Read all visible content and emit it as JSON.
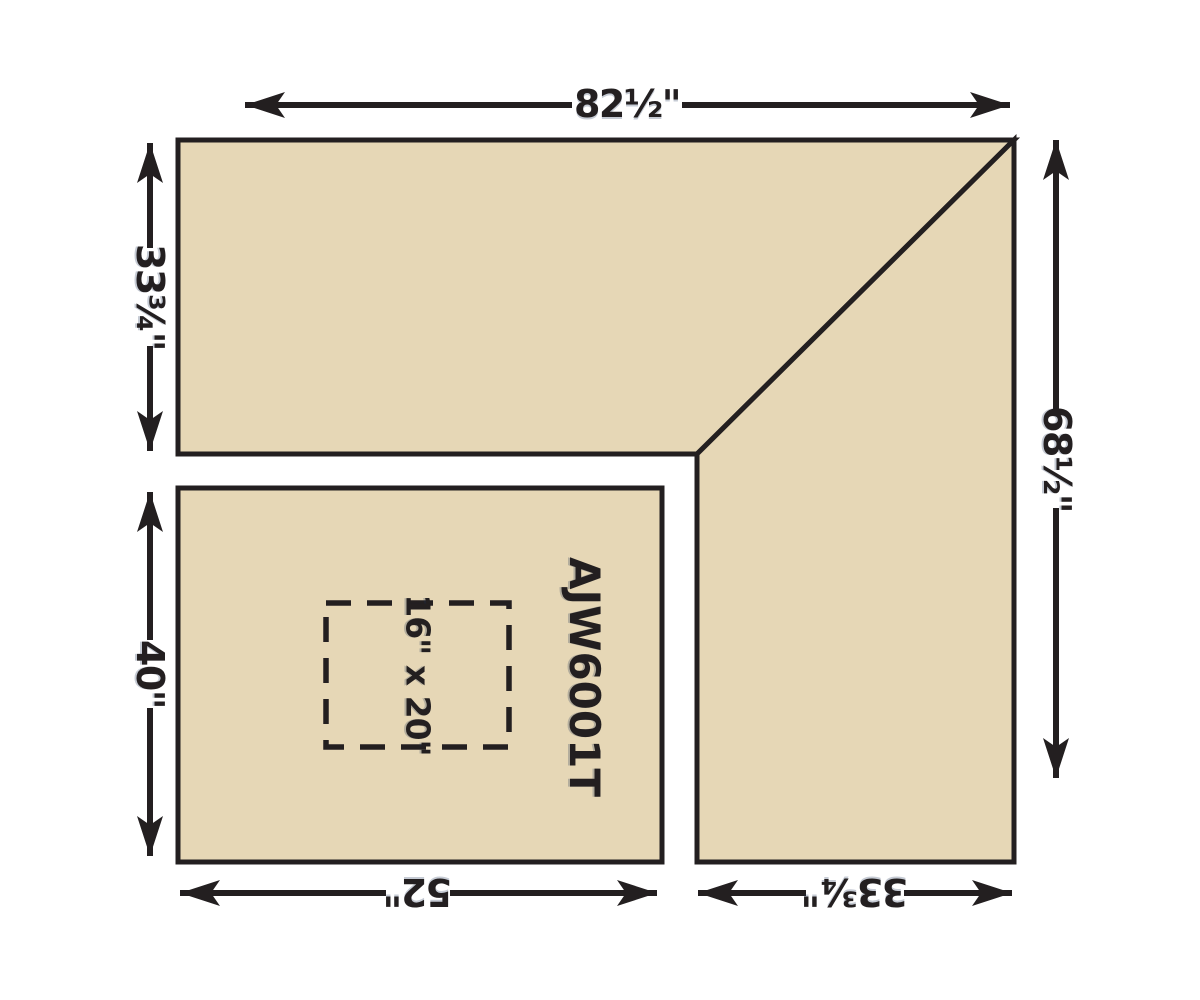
{
  "colors": {
    "surface": "#e6d7b6",
    "line": "#231f20",
    "background": "#ffffff",
    "label_text": "#231f20"
  },
  "diagram": {
    "labels": {
      "top_width": "82½\"",
      "upper_left_height": "33¾\"",
      "lower_left_height": "40\"",
      "right_height": "68½\"",
      "bottom_left_width": "52\"",
      "bottom_right_width": "33¾\"",
      "cutout_size": "16\" x 20\"",
      "model_number": "AJW6001T"
    }
  }
}
